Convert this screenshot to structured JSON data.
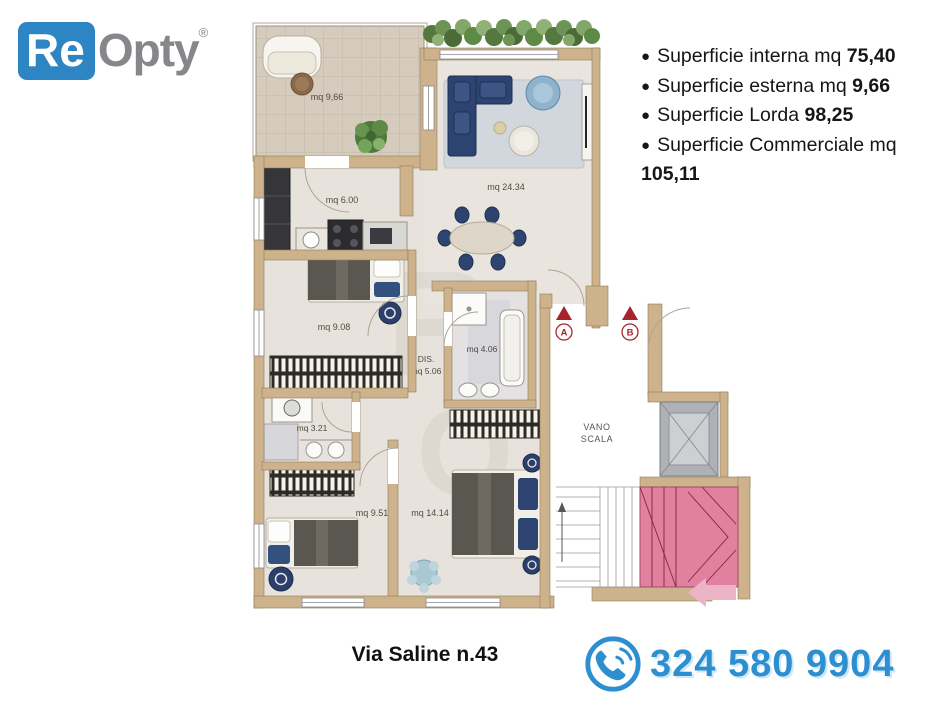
{
  "logo": {
    "re": "Re",
    "opty": "Opty",
    "registered": "®"
  },
  "surfaces": {
    "bullet": "●",
    "items": [
      {
        "label": "Superficie interna mq",
        "value": "75,40"
      },
      {
        "label": "Superficie esterna mq",
        "value": "9,66"
      },
      {
        "label": "Superficie Lorda",
        "value": "98,25"
      },
      {
        "label": "Superficie Commerciale mq",
        "value": "105,11"
      }
    ]
  },
  "plan": {
    "rooms": {
      "terrace": "mq 9,66",
      "living": "mq 24.34",
      "kitchen": "mq 6.00",
      "bedroom1": "mq 9.08",
      "hallway_title": "DIS.",
      "hallway": "mq 5.06",
      "bathroom1": "mq 4.06",
      "bathroom2": "mq 3.21",
      "bedroom2": "mq 9.51",
      "bedroom3": "mq 14.14"
    },
    "stairwell": {
      "line1": "VANO",
      "line2": "SCALA"
    },
    "entrances": {
      "a": "A",
      "b": "B"
    }
  },
  "footer": {
    "address": "Via Saline n.43",
    "phone": "324 580 9904"
  },
  "colors": {
    "brand_blue": "#2d86c3",
    "logo_gray": "#85878a",
    "phone_blue": "#2e8fd0",
    "wall_tan": "#cdb28c",
    "floor": "#e7e3dc",
    "stair_pink": "#e2809f",
    "marker_red": "#a8232e",
    "furniture_navy": "#2e4470"
  }
}
